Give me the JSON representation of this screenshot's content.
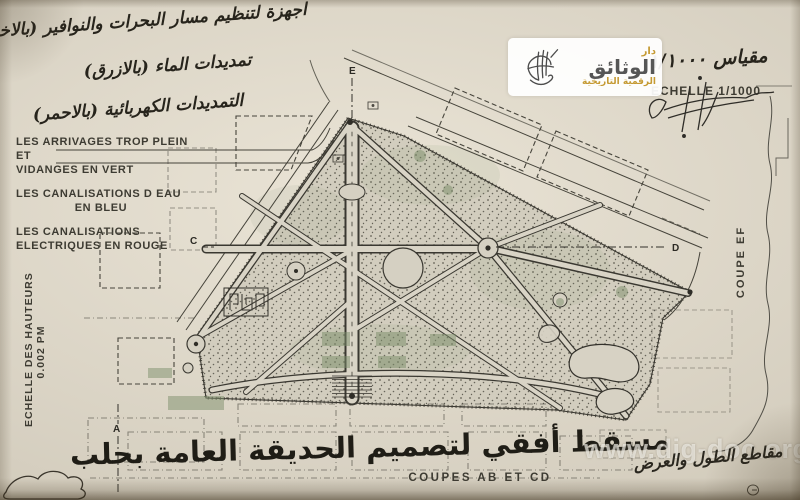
{
  "colors": {
    "paper": "#d8d2c3",
    "ink": "#35332c",
    "accent_gold": "#c59a33",
    "green": "#7d8f6b"
  },
  "header": {
    "lines": [
      "اجهزة لتنظيم مسار البحرات والنوافير (بالاخضر)",
      "تمديدات الماء (بالازرق)",
      "التمديدات الكهربائية (بالاحمر)"
    ]
  },
  "legend": {
    "items": [
      {
        "line1": "LES ARRIVAGES TROP PLEIN ET",
        "line2": "VIDANGES  EN  VERT"
      },
      {
        "line1": "LES CANALISATIONS D EAU",
        "line2": "EN BLEU"
      },
      {
        "line1": "LES CANALISATIONS",
        "line2": "ELECTRIQUES EN ROUGE"
      }
    ]
  },
  "heights_scale": {
    "line1": "ECHELLE DES HAUTEURS",
    "line2": "0.002 PM"
  },
  "scale": {
    "arabic": "مقياس ١/١٠٠٠",
    "latin": "ECHELLE 1/1000"
  },
  "sections": {
    "coupe_ef": "COUPE EF",
    "coupes_ab_cd": "COUPES  AB  ET  CD",
    "marker_e": "E",
    "marker_a": "A",
    "marker_c": "C",
    "marker_d": "D"
  },
  "title": {
    "arabic": "مسقط أفقي لتصميم الحديقة العامة بحلب"
  },
  "notes": {
    "bottom_right_arabic": "مقاطع الطول والعرض"
  },
  "watermark": {
    "brand_top": "دار",
    "brand_main": "الوثائق",
    "brand_sub": "الرقمية التاريخية",
    "url": "www.dig-doc.org"
  }
}
